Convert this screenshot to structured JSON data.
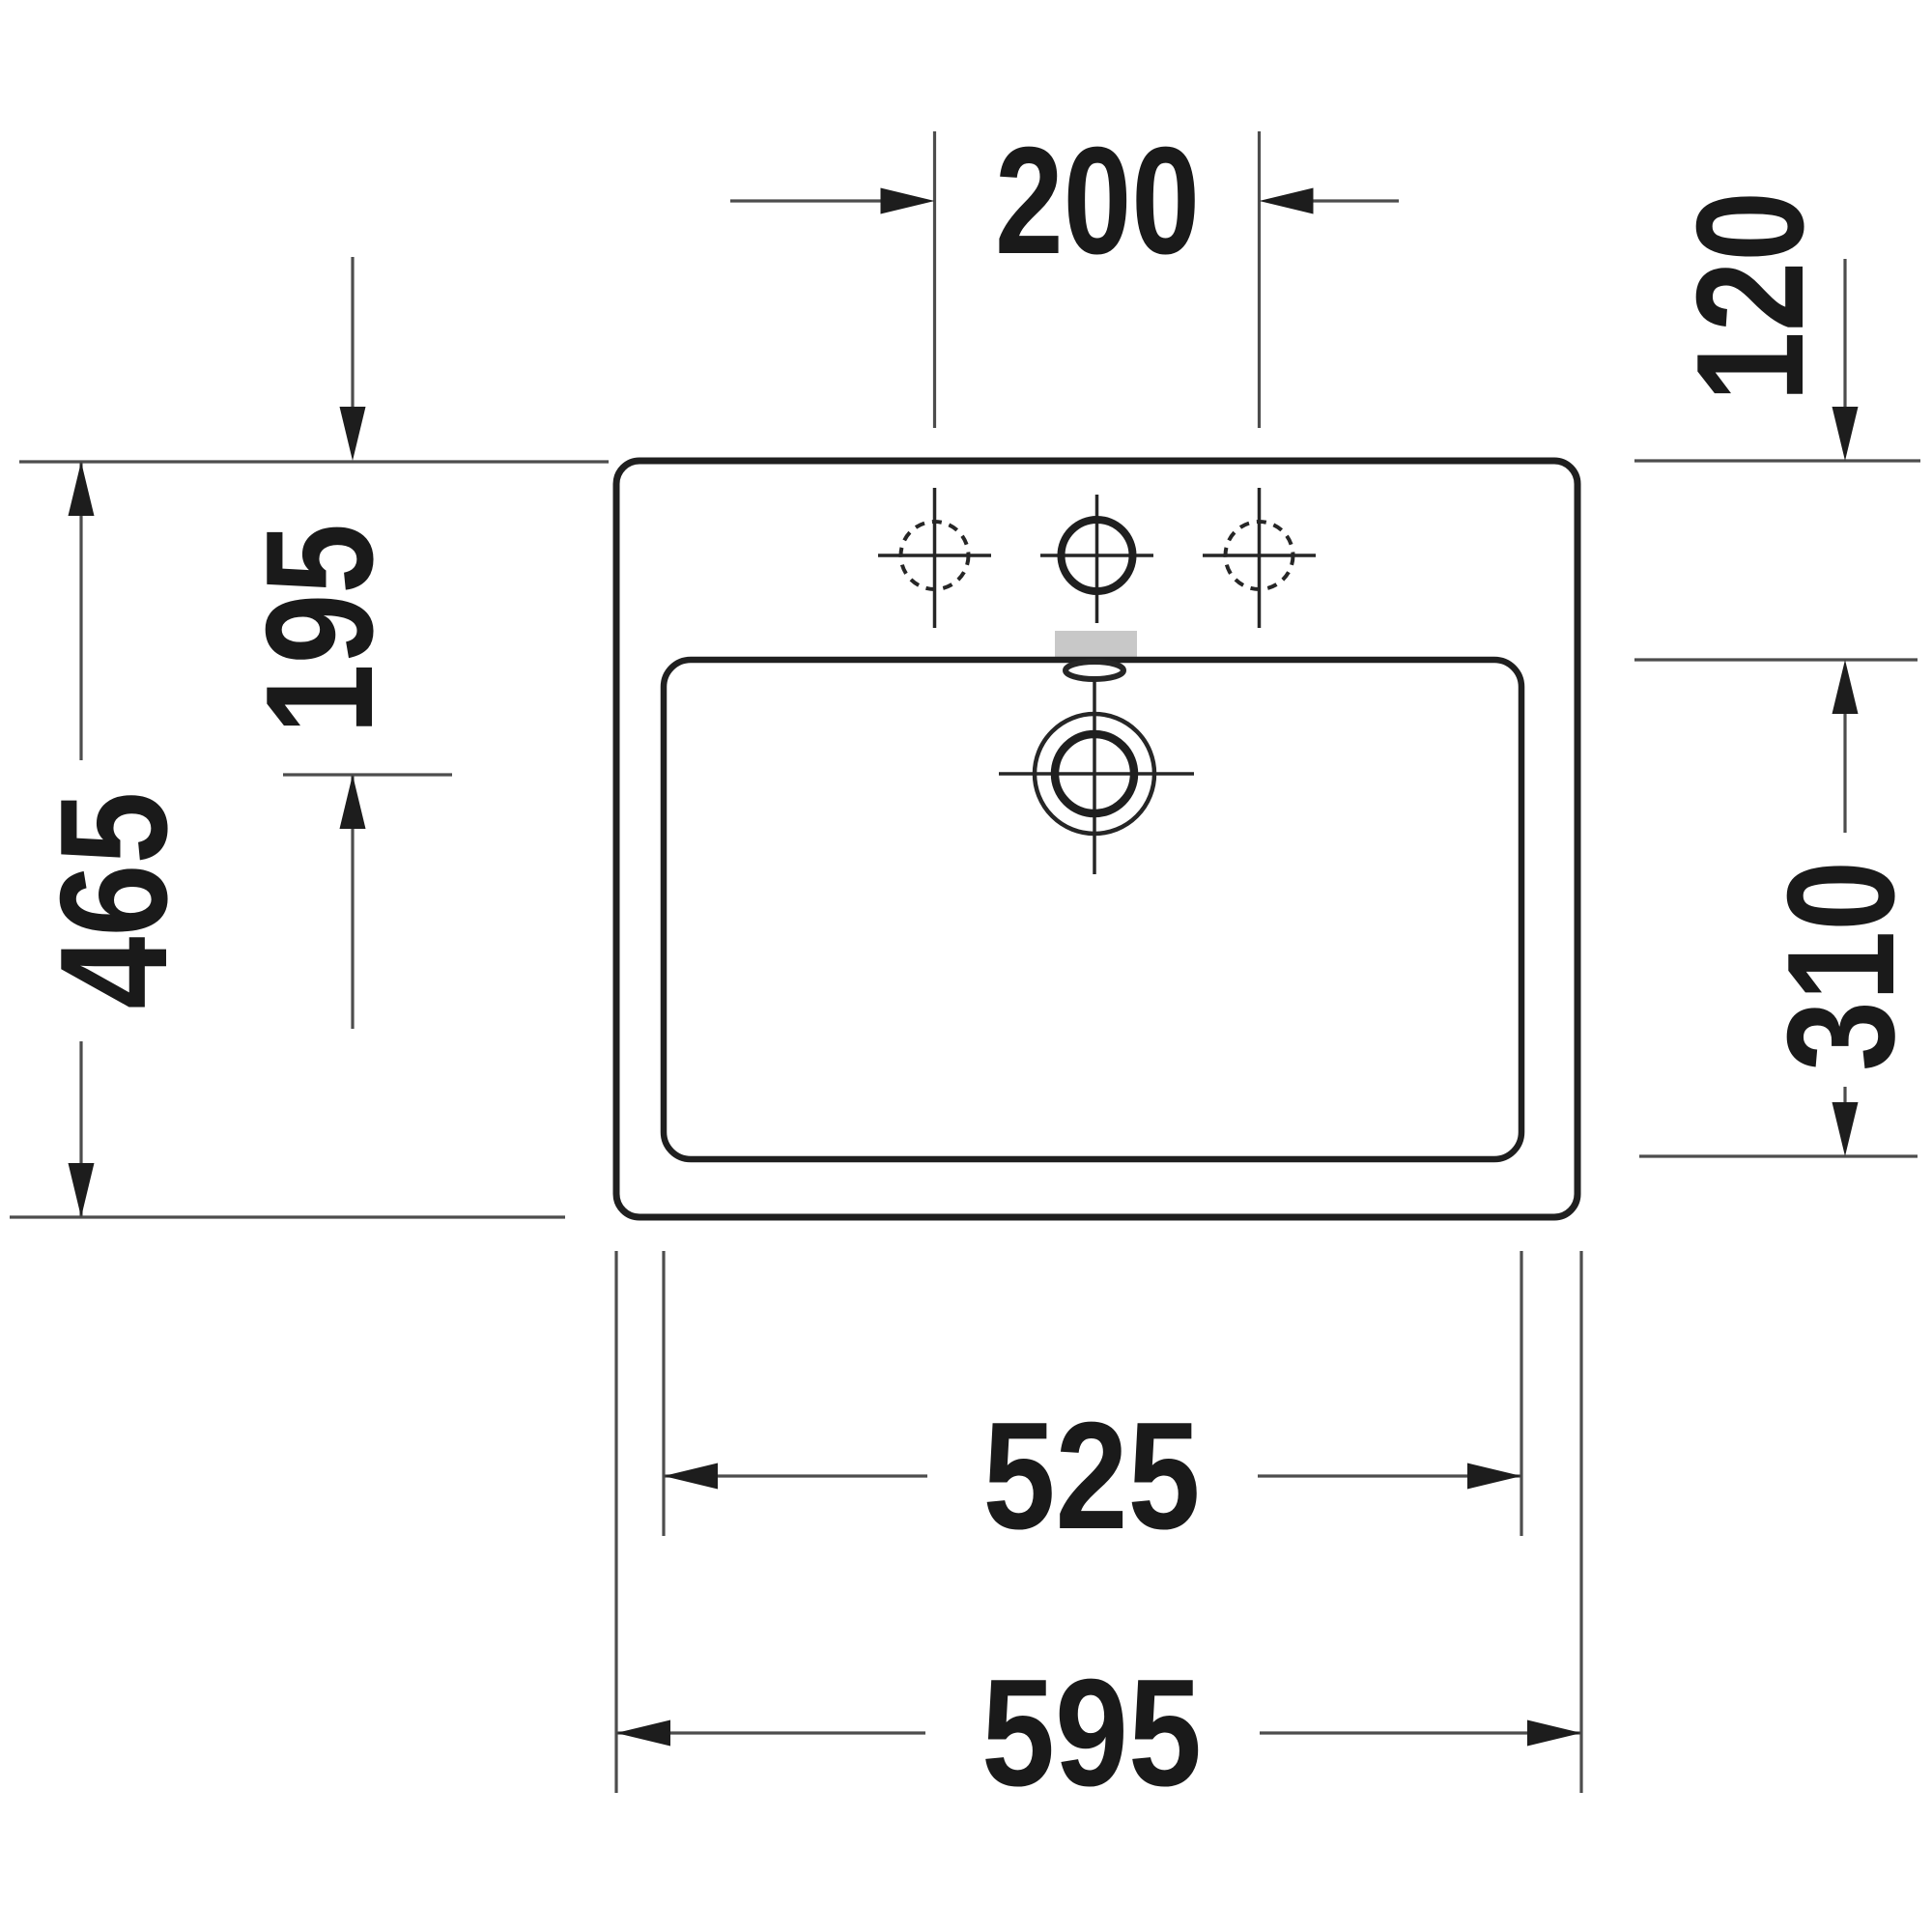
{
  "drawing": {
    "kind": "washbasin-plan-technical-drawing",
    "unit": "mm",
    "colors": {
      "line": "#1f1f1f",
      "dim": "#4d4d4d",
      "text": "#1a1a1a",
      "shadow": "#c8c8c8",
      "bg": "#ffffff"
    },
    "dimensions": {
      "tap_hole_spacing": "200",
      "rear_to_basin_edge": "120",
      "rear_to_drain_center": "195",
      "overall_depth": "465",
      "basin_depth": "310",
      "basin_width": "525",
      "overall_width": "595"
    },
    "features": {
      "tap_holes_total": 3,
      "center_tap_hole_style": "solid",
      "side_tap_hole_style": "dashed",
      "drain": "concentric-circles-with-crosshair",
      "overflow": "ellipse-at-basin-rear"
    }
  }
}
